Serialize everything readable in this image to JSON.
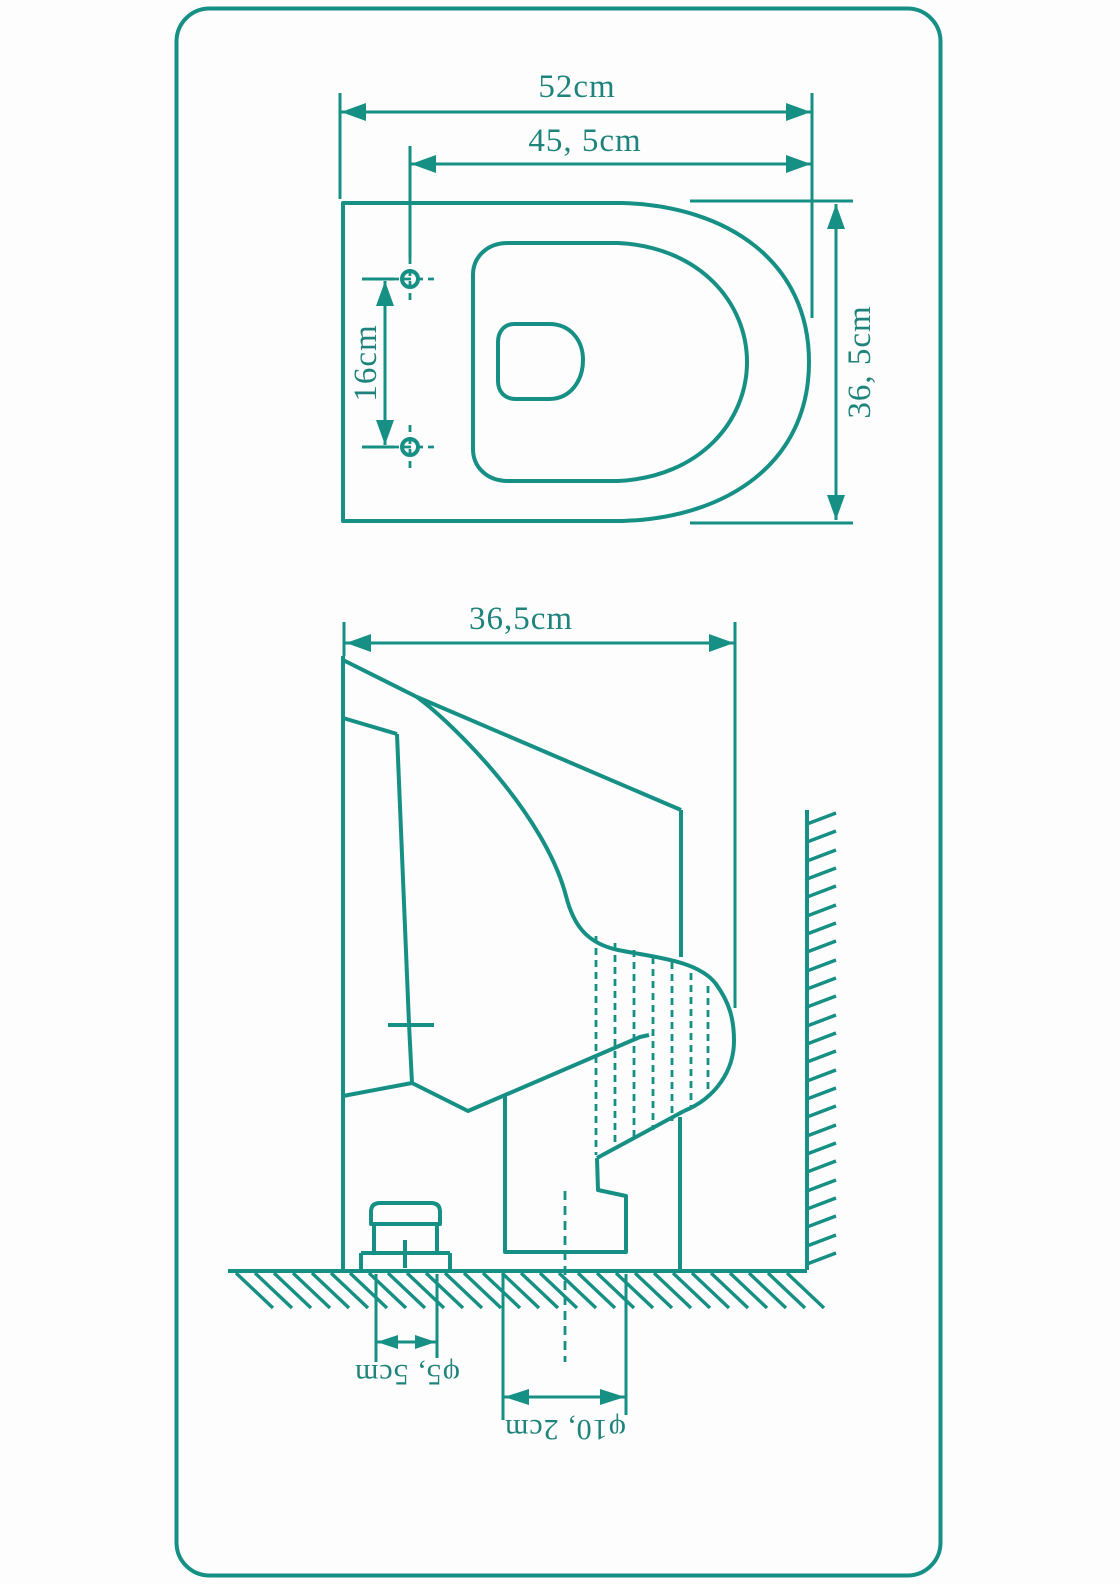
{
  "title": "toilet-dimension-drawing",
  "colors": {
    "line": "#169084",
    "text": "#1E837B",
    "background": "#FDFDFD"
  },
  "top_view": {
    "overall_width_label": "52cm",
    "seat_width_label": "45, 5cm",
    "mounting_hole_spacing_label": "16cm",
    "overall_depth_label": "36, 5cm"
  },
  "side_view": {
    "depth_label": "36,5cm",
    "inlet_diameter_label": "φ5, 5cm",
    "outlet_diameter_label": "φ10, 2cm"
  }
}
